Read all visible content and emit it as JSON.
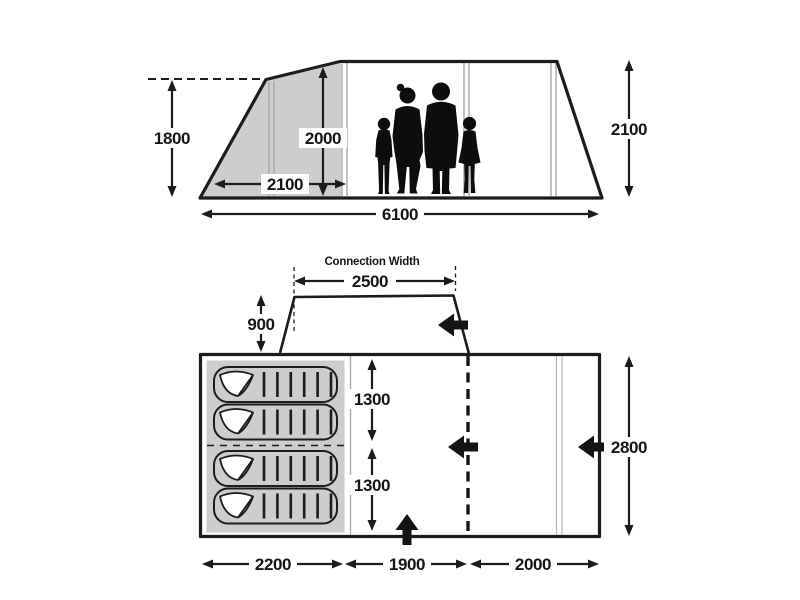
{
  "colors": {
    "line": "#1c1c1c",
    "shade_fill": "#cdcdcd",
    "seam_line": "#a9a9a9",
    "silhouette": "#0d0d0d",
    "background": "#ffffff"
  },
  "side_view": {
    "dim_front_height_mm": "1800",
    "dim_standing_height_mm": "2000",
    "dim_front_section_length_mm": "2100",
    "dim_total_length_mm": "6100",
    "dim_rear_height_mm": "2100"
  },
  "floor_plan": {
    "connection_width_label": "Connection Width",
    "dim_connection_width_mm": "2500",
    "dim_connection_depth_mm": "900",
    "dim_bed_upper_mm": "1300",
    "dim_bed_lower_mm": "1300",
    "dim_total_width_mm": "2800",
    "dim_bedroom_section_mm": "2200",
    "dim_living_section_mm": "1900",
    "dim_rear_section_mm": "2000"
  }
}
